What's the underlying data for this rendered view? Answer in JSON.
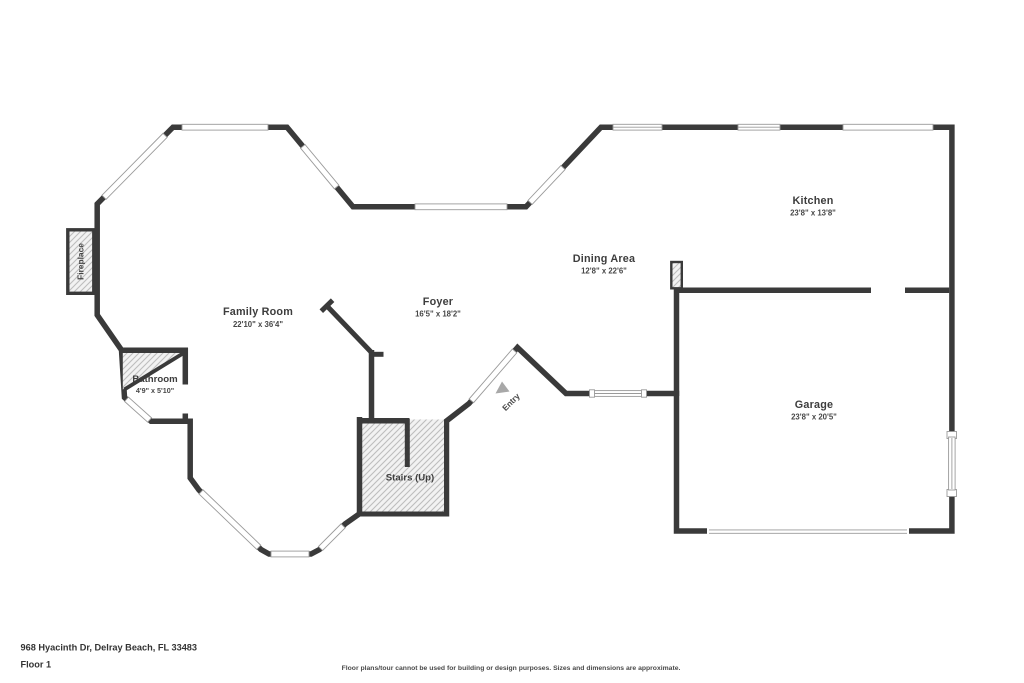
{
  "rooms": {
    "family_room": {
      "name": "Family Room",
      "dims": "22'10\" x 36'4\""
    },
    "foyer": {
      "name": "Foyer",
      "dims": "16'5\" x 18'2\""
    },
    "dining": {
      "name": "Dining Area",
      "dims": "12'8\" x 22'6\""
    },
    "kitchen": {
      "name": "Kitchen",
      "dims": "23'8\" x 13'8\""
    },
    "garage": {
      "name": "Garage",
      "dims": "23'8\" x 20'5\""
    },
    "bathroom": {
      "name": "Bathroom",
      "dims": "4'9\" x 5'10\""
    }
  },
  "labels": {
    "stairs": "Stairs (Up)",
    "entry": "Entry",
    "fireplace": "Fireplace"
  },
  "footer": {
    "address": "968 Hyacinth Dr, Delray Beach, FL 33483",
    "floor": "Floor 1",
    "disclaimer": "Floor plans/tour cannot be used for building or design purposes. Sizes and dimensions are approximate."
  },
  "colors": {
    "wall": "#3a3a3a",
    "floor": "#f4f4f4",
    "background": "#ffffff",
    "window_line": "#9a9a9a",
    "hatch_line": "#bdbdbd",
    "entry_arrow": "#a8a8a8",
    "text": "#3d3d3d"
  }
}
